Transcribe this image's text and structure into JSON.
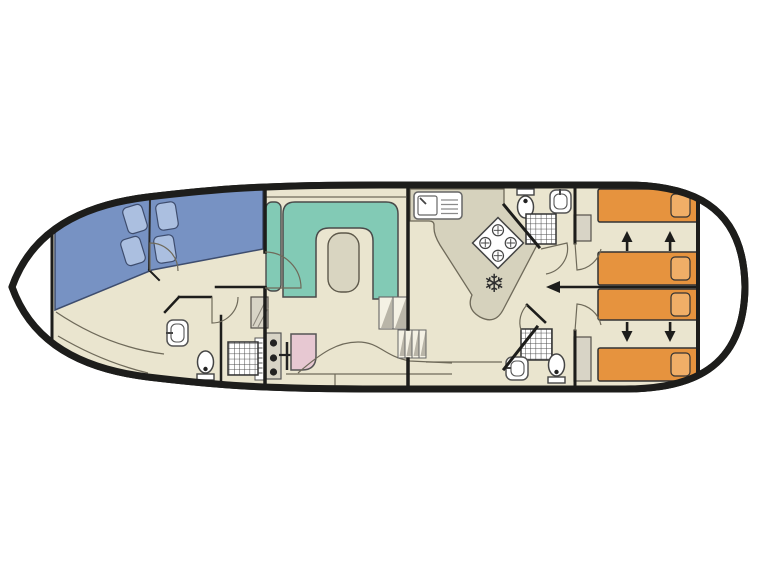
{
  "plan": {
    "kind": "canal-boat-floor-plan",
    "orientation": {
      "bow": "left",
      "stern": "right"
    },
    "areas": [
      "bow-deck",
      "bow-cabin",
      "bow-bathroom",
      "saloon",
      "helm-station",
      "galley",
      "corridor",
      "aft-cabin-top",
      "aft-bathroom-top",
      "aft-cabin-bottom",
      "aft-bathroom-bottom",
      "stern-deck"
    ],
    "features": {
      "bow_double_beds": 2,
      "bow_pillows": 4,
      "saloon_sofa": "u-shaped-bench",
      "saloon_table": 1,
      "helm_items": [
        "instrument-panel",
        "control-knobs",
        "steering-wheel",
        "helm-seat"
      ],
      "galley_items": [
        "sink-with-drainer",
        "hob-4-burner",
        "fridge-snowflake"
      ],
      "bathrooms": 3,
      "bathroom_fixtures": [
        "washbasin",
        "toilet",
        "shower"
      ],
      "aft_single_beds": 4,
      "aft_pillows": 4,
      "sliding_bed_arrows": 4,
      "cabin_partition_arrow": 1,
      "wardrobes": 3,
      "step_flights": 2
    }
  },
  "colors": {
    "hull_outline": "#1d1d1b",
    "deck_white": "#ffffff",
    "floor": "#eae5cf",
    "counter": "#d6d2bd",
    "bed_blue": "#7792c3",
    "pillow_blue": "#abbfe0",
    "sofa_teal": "#82cab5",
    "table": "#d9d5c1",
    "bed_orange": "#e6933e",
    "pillow_orange": "#f0ae67",
    "seat_pink": "#e7c8d2",
    "wardrobe": "#d8d4c6",
    "fixture_white": "#ffffff",
    "wall": "#1d1d1b",
    "line_thin": "#6f6a5a"
  },
  "icons": {
    "fridge_glyph": "❄",
    "names": [
      "double-bed-icon",
      "pillow-icon",
      "u-sofa-icon",
      "table-icon",
      "steering-wheel-icon",
      "helm-seat-icon",
      "instrument-panel-icon",
      "steps-icon",
      "galley-sink-icon",
      "hob-icon",
      "fridge-snowflake-icon",
      "shower-icon",
      "washbasin-icon",
      "toilet-icon",
      "wardrobe-icon",
      "slide-arrow-icon",
      "partition-arrow-icon",
      "door-swing-icon"
    ]
  }
}
